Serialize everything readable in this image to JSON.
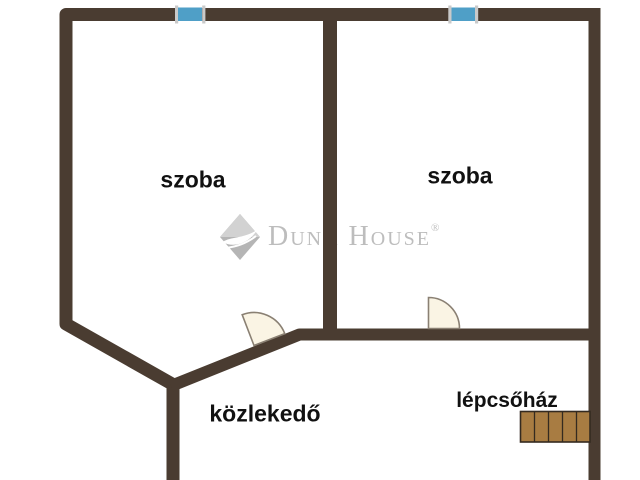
{
  "floorplan": {
    "rooms": [
      {
        "label": "szoba"
      },
      {
        "label": "szoba"
      },
      {
        "label": "közlekedő"
      },
      {
        "label": "lépcsőház"
      }
    ],
    "watermark": {
      "brand": "Duna House",
      "registered_mark": "®"
    },
    "features": {
      "windows": 2,
      "doors": 2,
      "stair_steps": 5
    },
    "colors": {
      "wall": "#4a3c31",
      "window_glass": "#4f9fc7",
      "window_frame": "#c9c9c9",
      "door_leaf": "#faf4e4",
      "door_outline": "#8a8073",
      "stairs_fill": "#a87c42",
      "stairs_outline": "#342a20",
      "watermark_gray": "#bdbdbd",
      "label_text": "#111111",
      "background": "#ffffff"
    }
  }
}
